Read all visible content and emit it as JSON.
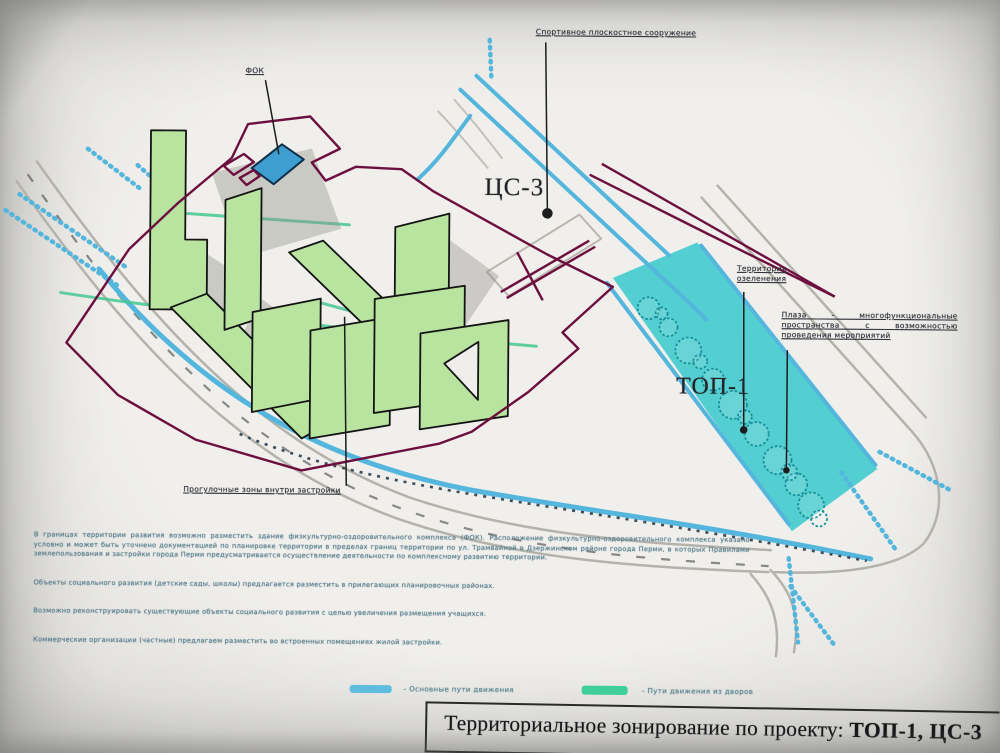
{
  "document": {
    "title_prefix": "Территориальное зонирование по проекту: ",
    "title_emphasis": "ТОП-1, ЦС-3"
  },
  "map": {
    "labels": {
      "fok": "ФОК",
      "sport_facility": "Спортивное плоскостное сооружение",
      "zone_cs3": "ЦС-3",
      "zone_top1": "ТОП-1",
      "greenery": "Территория озеленения",
      "plaza": "Плаза - многофункциональные пространства с возможностью проведения мероприятий",
      "walking_zones": "Прогулочные зоны внутри застройки"
    }
  },
  "notes": {
    "p1": "В границах территории развития возможно разместить здание физкультурно-оздоровительного комплекса (ФОК). Расположение физкультурно-оздоровительного комплекса указано условно и может быть уточнено документацией по планировке территории в пределах границ территории по ул. Трамвайной в Дзержинском районе города Перми, в которых Правилами землепользования и застройки города Перми предусматривается осуществление деятельности по комплексному развитию территории.",
    "p2": "Объекты социального развития (детские сады, школы) предлагается разместить в прилегающих планировочных районах.",
    "p3": "Возможно реконструировать существующие объекты социального развития с целью увеличения размещения учащихся.",
    "p4": "Коммерческие организации (частные) предлагаем разместить во встроенных помещениях жилой застройки."
  },
  "legend": {
    "items": [
      {
        "label": "- Основные пути движения",
        "color": "#5fbedf"
      },
      {
        "label": "- Пути движения из дворов",
        "color": "#40cf9b"
      }
    ]
  },
  "colors": {
    "building_fill": "#b9e4a0",
    "building_outline": "#141414",
    "fok_building_fill": "#3e9ecf",
    "boundary_line": "#6d0f3e",
    "park_fill": "#43cbce",
    "main_path": "#55b6dd",
    "yard_path": "#45c892",
    "road_gray": "#b3b2ab"
  }
}
